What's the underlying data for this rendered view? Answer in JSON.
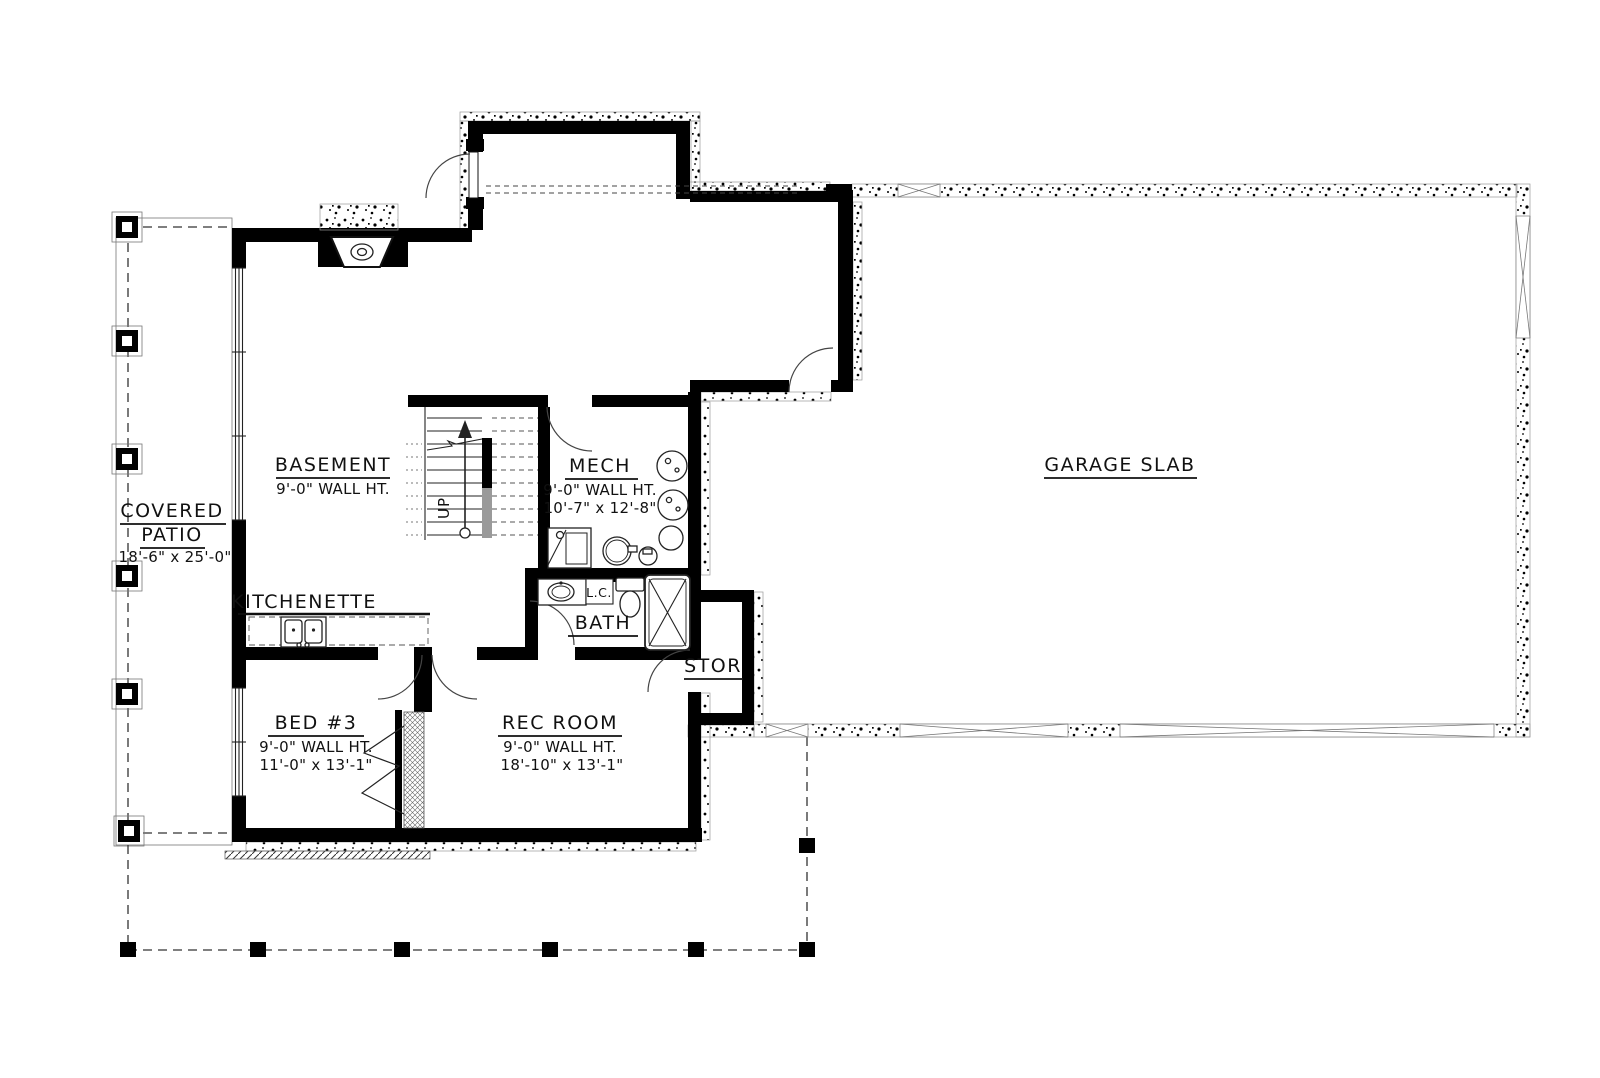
{
  "plan": {
    "background": "#ffffff",
    "wall_color": "#000000",
    "labels": {
      "covered_patio_1": "COVERED",
      "covered_patio_2": "PATIO",
      "covered_patio_dims": "18'-6\" x 25'-0\"",
      "basement_name": "BASEMENT",
      "basement_ht": "9'-0\" WALL HT.",
      "mech_name": "MECH",
      "mech_ht": "9'-0\" WALL HT.",
      "mech_dims": "10'-7\" x 12'-8\"",
      "garage_name": "GARAGE SLAB",
      "kitchenette_name": "KITCHENETTE",
      "bath_name": "BATH",
      "linen_closet": "L.C.",
      "stor_name": "STOR",
      "bed3_name": "BED #3",
      "bed3_ht": "9'-0\" WALL HT.",
      "bed3_dims": "11'-0\" x 13'-1\"",
      "rec_name": "REC ROOM",
      "rec_ht": "9'-0\" WALL HT.",
      "rec_dims": "18'-10\" x 13'-1\"",
      "stairs_up": "UP"
    }
  }
}
